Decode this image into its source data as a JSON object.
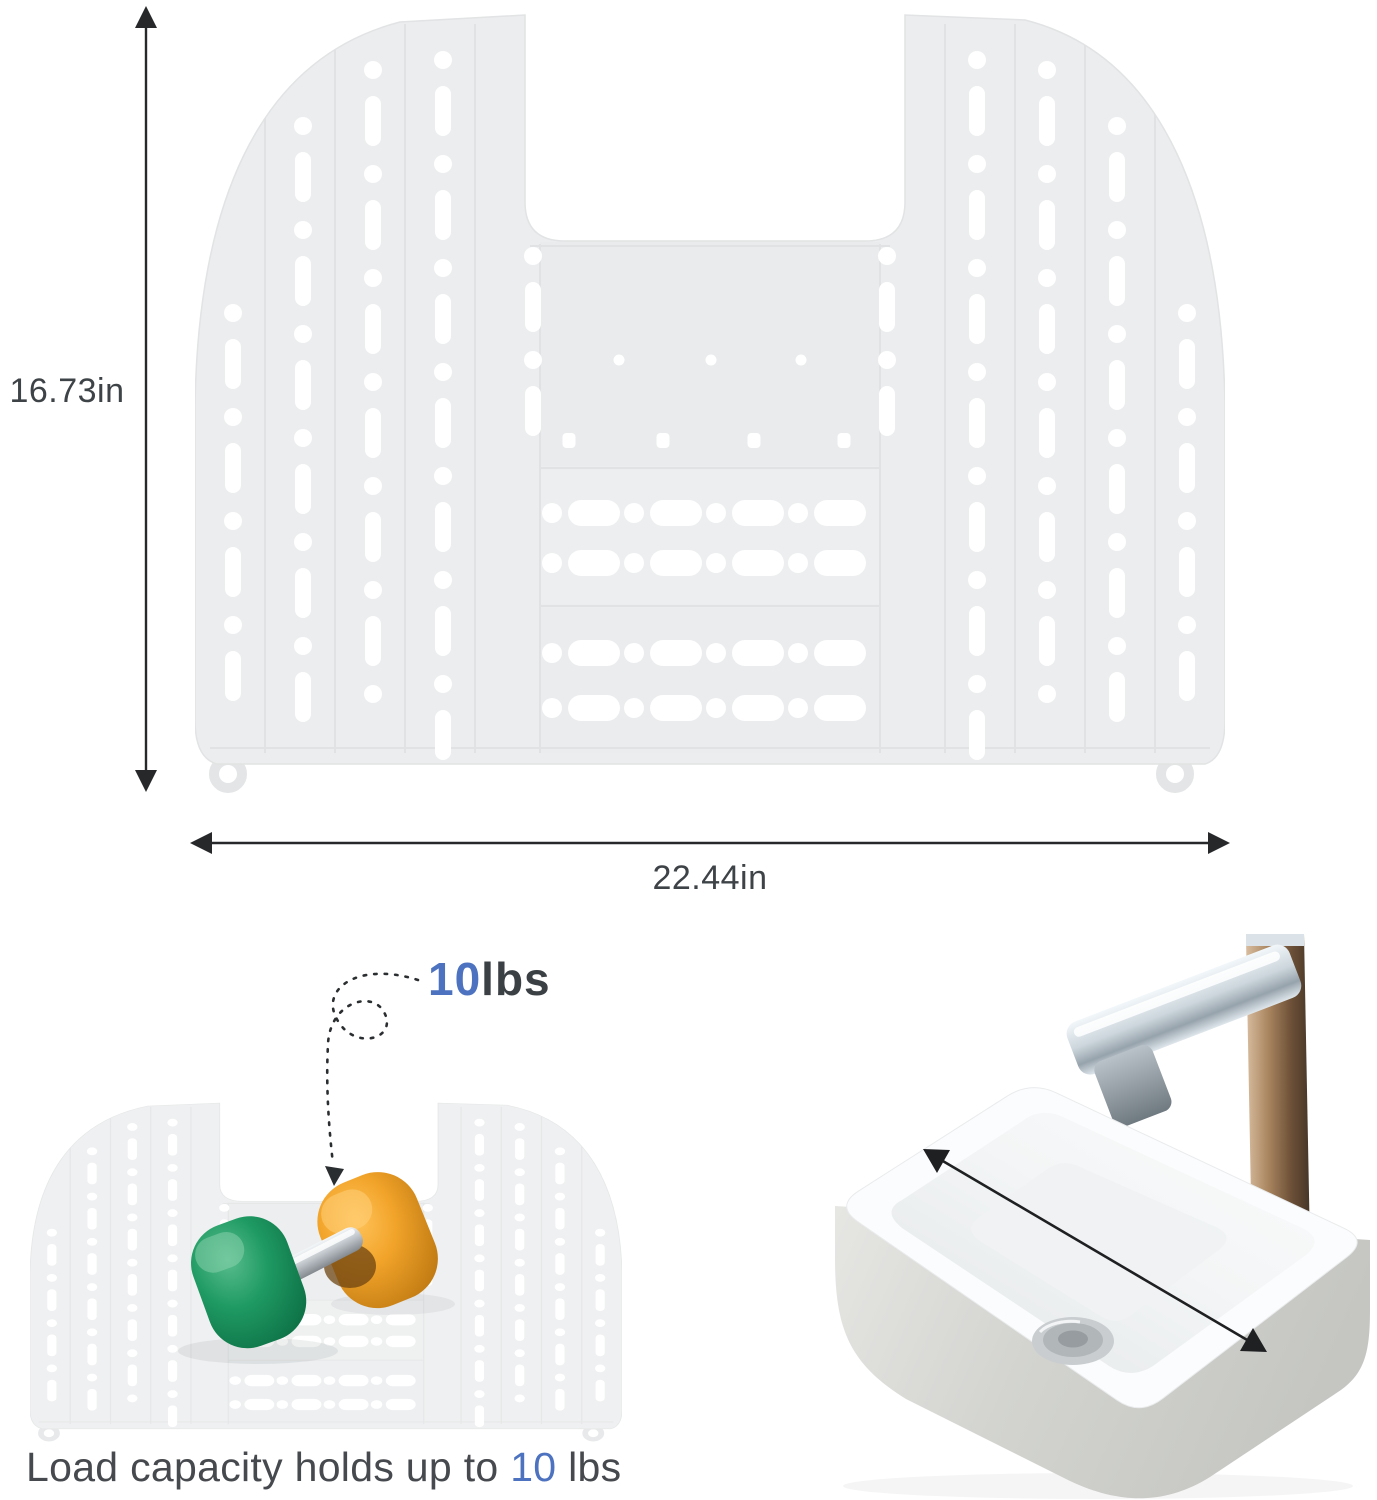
{
  "dimension_diagram": {
    "height_label": "16.73in",
    "width_label": "22.44in"
  },
  "load_demo": {
    "weight_value": "10",
    "weight_unit": "lbs",
    "caption_prefix": "Load capacity holds up to ",
    "caption_value": "10",
    "caption_suffix": " lbs"
  },
  "icons": {
    "height_arrow": "vertical double-headed measurement arrow",
    "width_arrow": "horizontal double-headed measurement arrow",
    "load_arrow": "dashed curved arrow with loop",
    "sink_width_arrow": "diagonal double-headed arrow inside sink"
  },
  "colors": {
    "accent_blue": "#4d72bf",
    "text_dark": "#3e4347",
    "mat_fill": "#ecedee",
    "mat_hole": "#ffffff",
    "dumbbell_green": "#1f9a63",
    "dumbbell_orange": "#f0a32a",
    "sink_body_gray": "#cfd0cc",
    "faucet_bronze": "#6e5138",
    "arrow_black": "#26282a"
  }
}
